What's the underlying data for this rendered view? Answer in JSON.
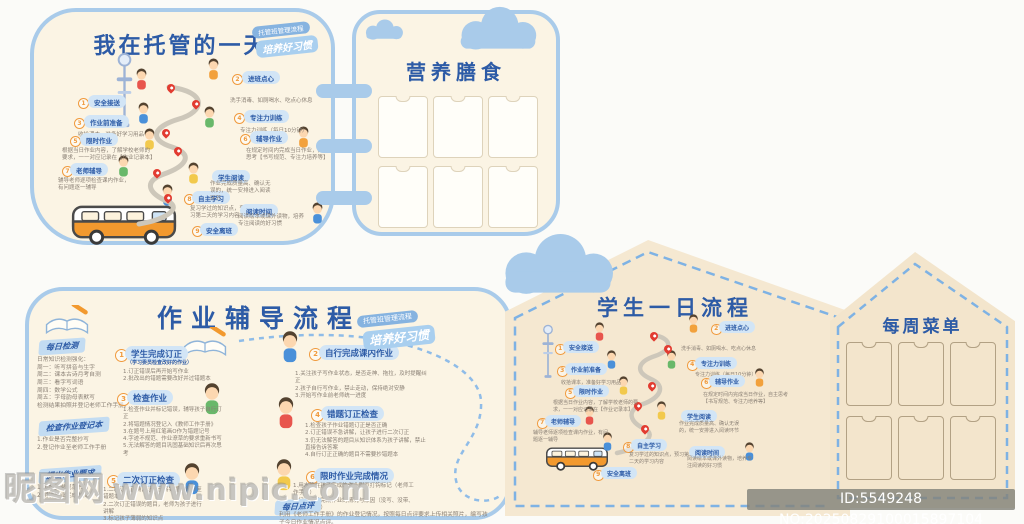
{
  "meta": {
    "watermark_brand": "昵图网",
    "watermark_url": "www.nipic.com",
    "id_text": "ID:5549248 NO:20250829100015897104"
  },
  "colors": {
    "panel_cream": "#fbf4e4",
    "panel_cream_dark": "#f5e8d1",
    "border_blue": "#a9cbea",
    "title_blue": "#2d5ba6",
    "pill_blue": "#d2e5f6",
    "road_gray": "#cdc7ba",
    "pin_red": "#e23b30",
    "number_orange": "#f09a3d",
    "bus_orange": "#f2992e",
    "text_gray": "#8b8176"
  },
  "badges": {
    "b1": "托管班管理流程",
    "b2": "培养好习惯"
  },
  "panel_day": {
    "title": "我在托管的一天"
  },
  "panel_meals": {
    "title": "营养膳食",
    "slot_count": 6
  },
  "panel_schedule": {
    "title": "学生一日流程"
  },
  "panel_menu": {
    "title": "每周菜单",
    "slot_count": 6
  },
  "day_steps": [
    {
      "num": "1",
      "label": "安全接送",
      "desc": ""
    },
    {
      "num": "2",
      "label": "进班点心",
      "desc": "洗手消毒、如厕喝水、吃点心休息"
    },
    {
      "num": "3",
      "label": "作业前准备",
      "desc": "收拾课本，准备好学习用品"
    },
    {
      "num": "4",
      "label": "专注力训练",
      "desc": "专注力训练（每日10分钟）"
    },
    {
      "num": "5",
      "label": "限时作业",
      "desc": "根据当日作业内容，了解学校老师的要求，一一对应记录在【作业记录本】"
    },
    {
      "num": "6",
      "label": "辅导作业",
      "desc": "在规定时间内完成当日作业，自主思考【书写规范、专注力培养等】"
    },
    {
      "num": "7",
      "label": "老师辅导",
      "desc": "辅导老师逐项检查课内作业，有问题逐一辅导"
    },
    {
      "num": "8",
      "label": "自主学习",
      "desc": "复习学过的知识点，预习第二天的学习内容"
    },
    {
      "num": "",
      "label": "学生阅读",
      "desc": "作业完成质量高、确认无误的，统一安排进入阅读环节"
    },
    {
      "num": "",
      "label": "阅读时间",
      "desc": "阅读绘本或课外读物，培养专注阅读的好习惯"
    },
    {
      "num": "9",
      "label": "安全离班",
      "desc": ""
    }
  ],
  "panel_homework": {
    "title": "作业辅导流程",
    "sidebar": [
      {
        "label": "每日检测",
        "lines": [
          "日常知识检测强化：",
          "周一：听写拼音与生字",
          "周二：课本古诗月考自测",
          "周三：看字写词语",
          "周四：数学公式",
          "周五：字母韵母表默写",
          "检测结果拍照并登记老师工作手册。"
        ]
      },
      {
        "label": "检查作业登记本",
        "lines": [
          "1.作业是否完整抄写",
          "2.登记作业至老师工作手册"
        ]
      },
      {
        "label": "提出作业要求",
        "lines": [
          "1.按照要求规范书写",
          "2.明确作业完成时间"
        ]
      }
    ],
    "steps": [
      {
        "num": "1",
        "label": "学生完成订正",
        "note": "（学习委员检查改好的作业）",
        "lines": [
          "1.订正错误后再开始写作业",
          "2.批改出的错题需要改好并过错题本"
        ]
      },
      {
        "num": "2",
        "label": "自行完成课内作业",
        "lines": [
          "1.关注孩子写作业状态，是否走神、拖拉，及时提醒纠正",
          "2.孩子自行写作业，禁止走动，保持绝对安静",
          "3.开始写作业前老师统一进度"
        ]
      },
      {
        "num": "3",
        "label": "检查作业",
        "lines": [
          "1.检查作业并标记错误，辅导孩子自行订正",
          "2.将错题情况登记入《教师工作手册》",
          "3.在题号上用红笔画O作为错题记号",
          "4.字迹不规范、作业潦草的要求重新书写",
          "5.无法解答的题目巩固基础知识后再次思考"
        ]
      },
      {
        "num": "4",
        "label": "错题订正检查",
        "lines": [
          "1.检查孩子作业错题订正是否正确",
          "2.订正错误不急讲解，让孩子进行二次订正",
          "3.仍无法解答的题目从知识体系为孩子讲解，禁止直接告诉答案",
          "4.自行订正正确的题目不需要抄错题本"
        ]
      },
      {
        "num": "5",
        "label": "二次订正检查",
        "lines": [
          "1.二次订正正确，让孩子将错题自行抄至错题本",
          "2.二次订正错误的题目，老师为孩子进行讲解",
          "3.标记孩子薄弱的知识点"
        ]
      },
      {
        "num": "6",
        "label": "限时作业完成情况",
        "lines": [
          "1.用水笔在孩子完成的作业附页打钩标记（老师工作手册）",
          "2.记录无法完成作业的情况与原因（没写、没带、需要材料等）"
        ]
      }
    ],
    "footer": {
      "label": "每日点评",
      "text": "利用《老师工作手册》的作业登记情况，按照每日点评要求上传相关照片，编写孩子今日作业情况点评。"
    }
  }
}
